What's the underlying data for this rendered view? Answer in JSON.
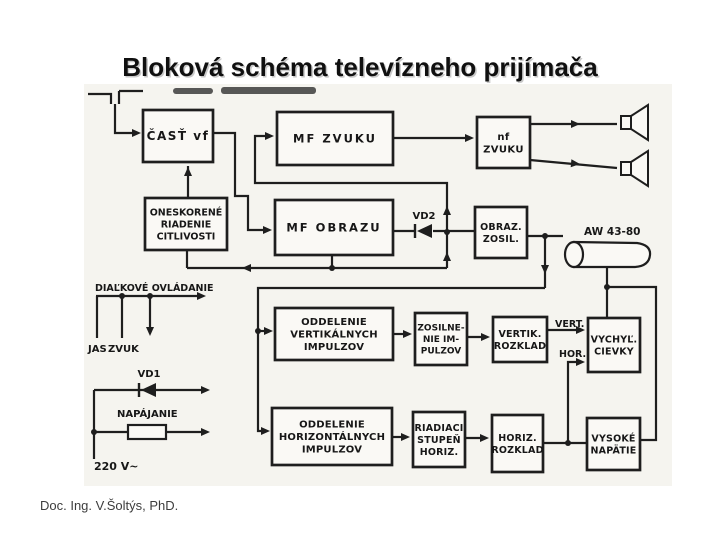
{
  "slide": {
    "title": "Bloková schéma televízneho prijímača",
    "credit": "Doc. Ing. V.Šoltýs, PhD."
  },
  "colors": {
    "ink": "#1e1e1e",
    "scan_paper": "#f5f4ef",
    "box_fill": "#faf9f5"
  },
  "diagram": {
    "blocks": [
      {
        "id": "cast-vf",
        "lines": [
          "ČASŤ vf"
        ]
      },
      {
        "id": "mf-zvuku",
        "lines": [
          "MF ZVUKU"
        ]
      },
      {
        "id": "nf-zvuku",
        "lines": [
          "nf",
          "ZVUKU"
        ]
      },
      {
        "id": "oneskorene-riadenie-citlivosti",
        "lines": [
          "ONESKORENÉ",
          "RIADENIE",
          "CITLIVOSTI"
        ]
      },
      {
        "id": "mf-obrazu",
        "lines": [
          "MF OBRAZU"
        ]
      },
      {
        "id": "obraz-zosil",
        "lines": [
          "OBRAZ.",
          "ZOSIL."
        ]
      },
      {
        "id": "oddelenie-vertikalnych",
        "lines": [
          "ODDELENIE",
          "VERTIKÁLNYCH",
          "IMPULZOV"
        ]
      },
      {
        "id": "zosilnenie-impulzov",
        "lines": [
          "ZOSILNE-",
          "NIE IM-",
          "PULZOV"
        ]
      },
      {
        "id": "vertik-rozklad",
        "lines": [
          "VERTIK.",
          "ROZKLAD"
        ]
      },
      {
        "id": "vychyl-cievky",
        "lines": [
          "VYCHYĽ.",
          "CIEVKY"
        ]
      },
      {
        "id": "oddelenie-horizontalnych",
        "lines": [
          "ODDELENIE",
          "HORIZONTÁLNYCH",
          "IMPULZOV"
        ]
      },
      {
        "id": "riadiaci-stupen-horiz",
        "lines": [
          "RIADIACI",
          "STUPEŇ",
          "HORIZ."
        ]
      },
      {
        "id": "horiz-rozklad",
        "lines": [
          "HORIZ.",
          "ROZKLAD"
        ]
      },
      {
        "id": "vysoke-napatie",
        "lines": [
          "VYSOKÉ",
          "NAPÄTIE"
        ]
      }
    ],
    "labels": [
      {
        "id": "vd2",
        "text": "VD2"
      },
      {
        "id": "aw-43-80",
        "text": "AW 43-80"
      },
      {
        "id": "vert",
        "text": "VERT."
      },
      {
        "id": "hor",
        "text": "HOR."
      },
      {
        "id": "dialkove-ovladanie",
        "text": "DIAĽKOVÉ OVLÁDANIE"
      },
      {
        "id": "jas",
        "text": "JAS"
      },
      {
        "id": "zvuk",
        "text": "ZVUK"
      },
      {
        "id": "vd1",
        "text": "VD1"
      },
      {
        "id": "napajanie",
        "text": "NAPÁJANIE"
      },
      {
        "id": "220v",
        "text": "220 V~"
      }
    ]
  }
}
